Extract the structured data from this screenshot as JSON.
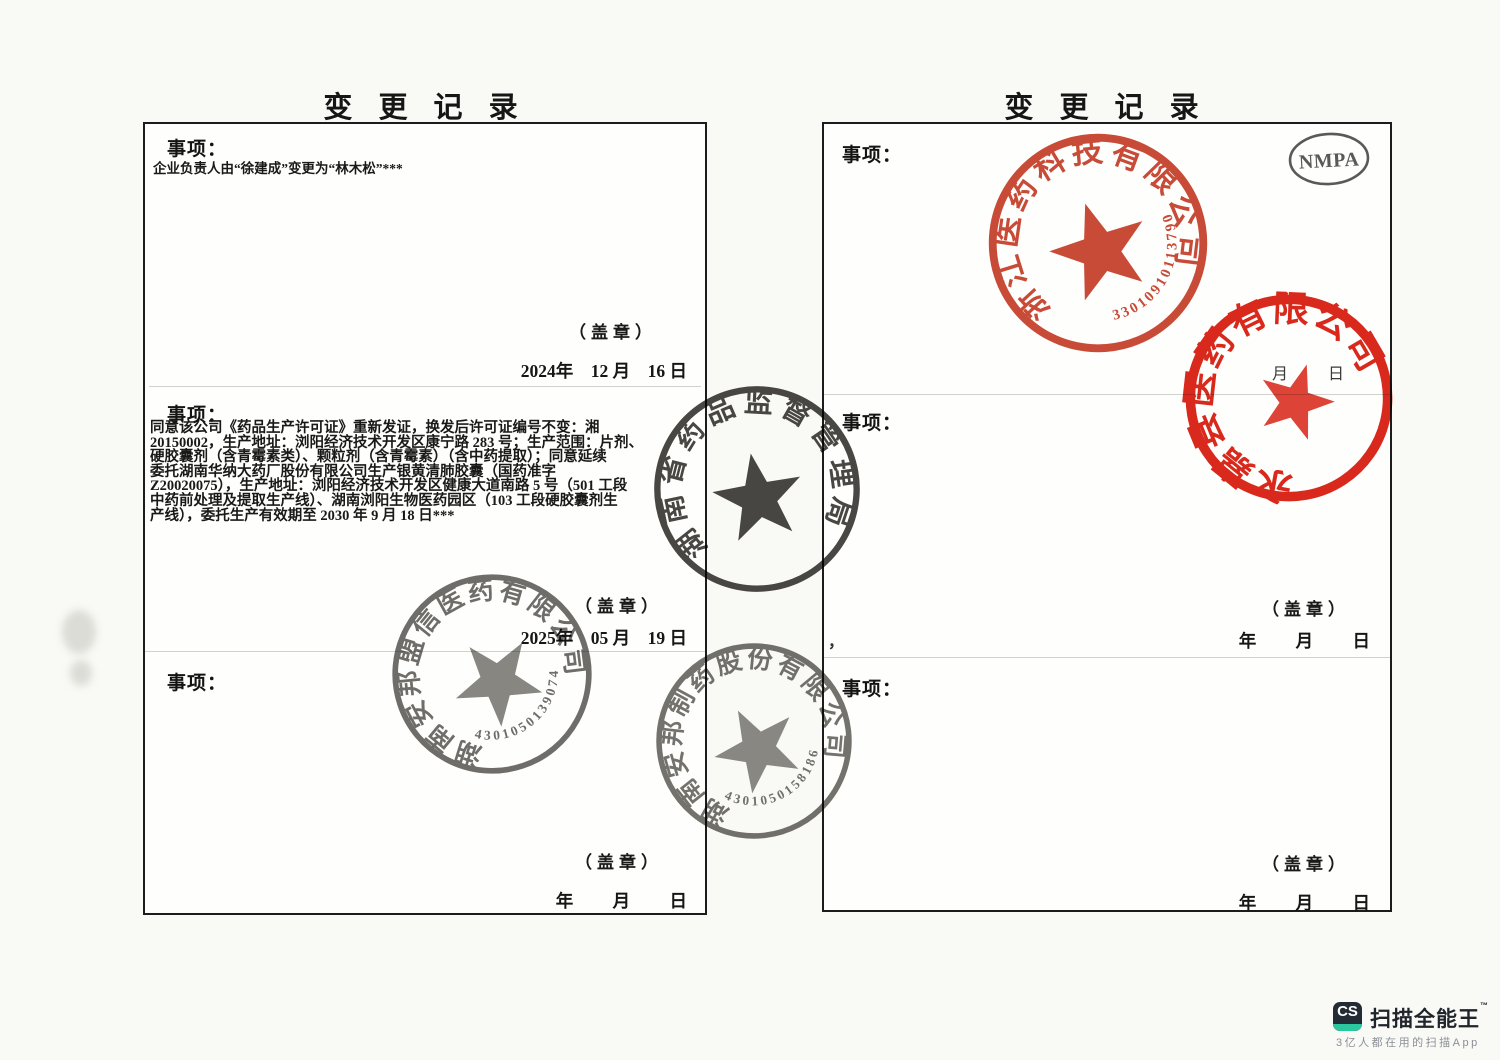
{
  "doc": {
    "left": {
      "title": "变 更 记 录",
      "s1_label": "事项：",
      "s1_body": "企业负责人由“徐建成”变更为“林木松”***",
      "s1_seal": "（盖章）",
      "s1_date": "2024年    12 月    16 日",
      "s2_label": "事项：",
      "s2_lines": [
        "同意该公司《药品生产许可证》重新发证，换发后许可证编号不变：湘",
        "20150002，生产地址：浏阳经济技术开发区康宁路 283 号；生产范围：片剂、",
        "硬胶囊剂（含青霉素类）、颗粒剂（含青霉素）（含中药提取）；同意延续",
        "委托湖南华纳大药厂股份有限公司生产银黄清肺胶囊（国药准字",
        "Z20020075），生产地址：浏阳经济技术开发区健康大道南路 5 号（501 工段",
        "中药前处理及提取生产线）、湖南浏阳生物医药园区（103 工段硬胶囊剂生",
        "产线），委托生产有效期至 2030 年 9 月 18 日***"
      ],
      "s2_seal": "（盖章）",
      "s2_date": "2025年    05 月    19 日",
      "s3_label": "事项：",
      "s3_seal": "（盖章）",
      "s3_date": "年         月         日"
    },
    "right": {
      "title": "变 更 记 录",
      "s1_label": "事项：",
      "s1_faint_date": "月          日",
      "comma_mark": "，",
      "s2_label": "事项：",
      "s2_seal": "（盖章）",
      "s2_date": "年         月         日",
      "s3_label": "事项：",
      "s3_seal": "（盖章）",
      "s3_date": "年         月         日"
    }
  },
  "stamps": {
    "hunan_mpa": {
      "ring": "湖南省药品监督管理局",
      "color": "#35332f"
    },
    "anbang_meng": {
      "ring": "湖南安邦盟信医药有限公司",
      "number": "4301050139074",
      "color": "#5b5955"
    },
    "anbang_pharma": {
      "ring": "湖南安邦制药股份有限公司",
      "number": "4301050158186",
      "color": "#605e5a"
    },
    "zhejiang_co": {
      "ring": "浙江医药科技有限公司",
      "number": "33010910113790",
      "color": "#c53b27"
    },
    "yongjia_co": {
      "ring": "永嘉县医药有限公司",
      "color": "#d8180a"
    }
  },
  "nmpa_seal": {
    "label": "NMPA"
  },
  "watermark": {
    "logo": "CS",
    "title": "扫描全能王",
    "tm": "™",
    "subtitle": "3亿人都在用的扫描App"
  }
}
